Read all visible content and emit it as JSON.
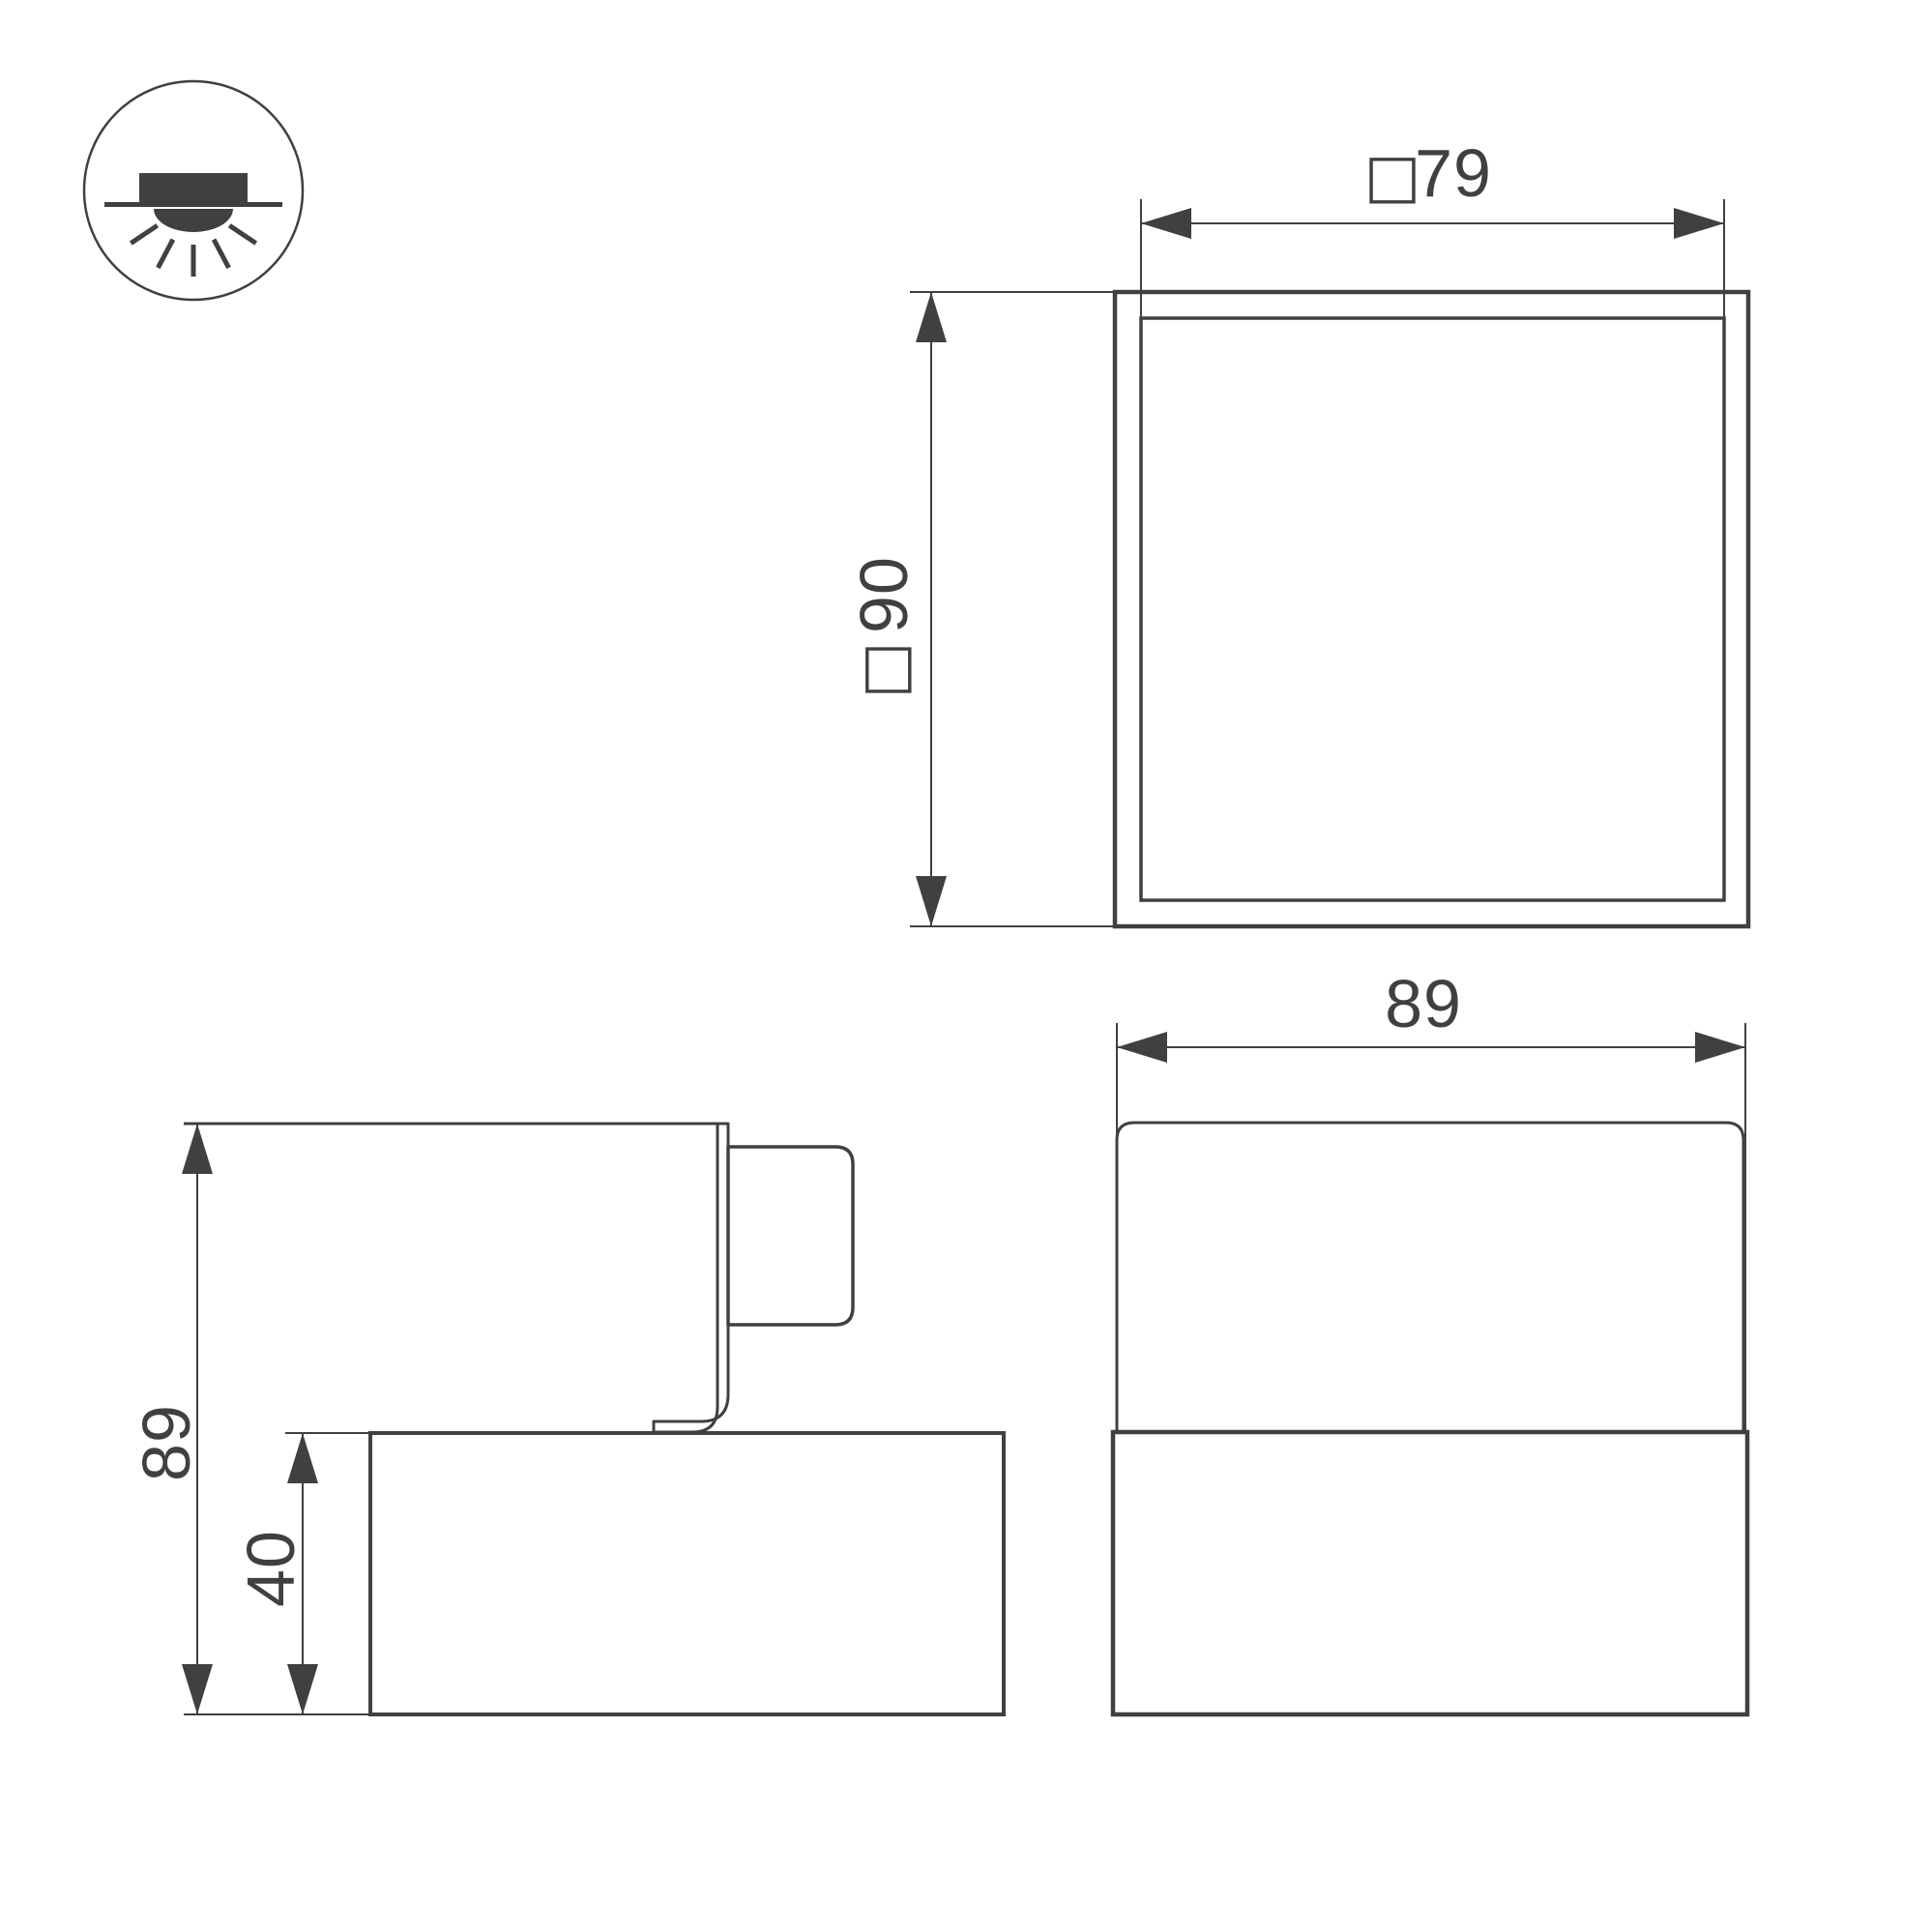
{
  "colors": {
    "background": "#ffffff",
    "line": "#3f4042",
    "text": "#3f4042"
  },
  "icon": {
    "name": "recessed-downlight-icon"
  },
  "symbols": {
    "square": "□"
  },
  "dimensions": {
    "plan_width": {
      "prefix": "□",
      "value": "79"
    },
    "plan_size": {
      "prefix": "□",
      "value": "90"
    },
    "side_total_height": {
      "value": "89"
    },
    "side_base_height": {
      "value": "40"
    },
    "front_width": {
      "value": "89"
    }
  }
}
